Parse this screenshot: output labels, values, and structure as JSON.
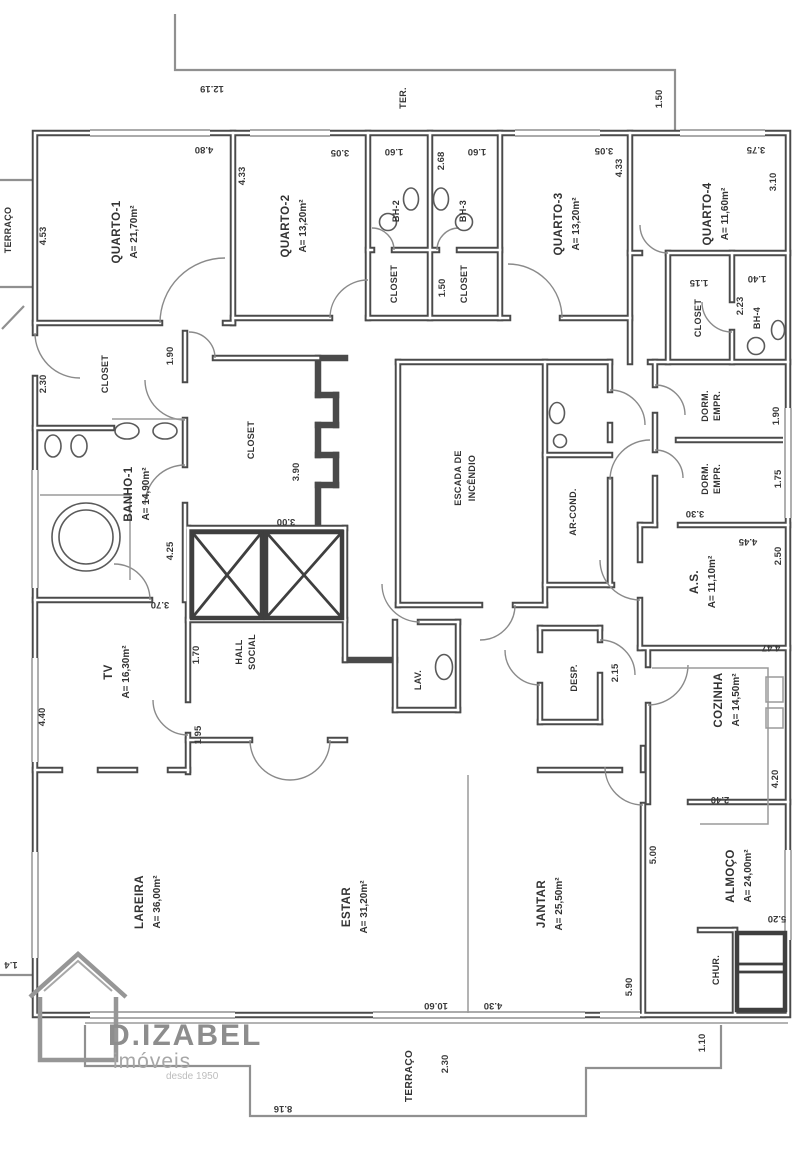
{
  "branding": {
    "name": "D.IZABEL",
    "subtitle": "imóveis",
    "tagline": "desde 1950"
  },
  "rooms": {
    "quarto1": {
      "name": "QUARTO-1",
      "area": "A= 21,70m²"
    },
    "quarto2": {
      "name": "QUARTO-2",
      "area": "A= 13,20m²"
    },
    "quarto3": {
      "name": "QUARTO-3",
      "area": "A= 13,20m²"
    },
    "quarto4": {
      "name": "QUARTO-4",
      "area": "A= 11,60m²"
    },
    "banho1": {
      "name": "BANHO-1",
      "area": "A= 14,90m²"
    },
    "tv": {
      "name": "TV",
      "area": "A= 16,30m²"
    },
    "cozinha": {
      "name": "COZINHA",
      "area": "A= 14,50m²"
    },
    "lareira": {
      "name": "LAREIRA",
      "area": "A= 36,00m²"
    },
    "estar": {
      "name": "ESTAR",
      "area": "A= 31,20m²"
    },
    "jantar": {
      "name": "JANTAR",
      "area": "A= 25,50m²"
    },
    "almoco": {
      "name": "ALMOÇO",
      "area": "A= 24,00m²"
    },
    "area_servico": {
      "name": "A.S.",
      "area": "A= 11,10m²"
    },
    "hall": {
      "line1": "HALL",
      "line2": "SOCIAL"
    },
    "escada": {
      "line1": "ESCADA DE",
      "line2": "INCÊNDIO"
    },
    "dorm_empr": {
      "line1": "DORM.",
      "line2": "EMPR."
    },
    "ar_cond": "AR-COND.",
    "lav": "LAV.",
    "desp": "DESP.",
    "chur": "CHUR.",
    "bh2": "BH-2",
    "bh3": "BH-3",
    "bh4": "BH-4",
    "closet": "CLOSET",
    "ter": "TER.",
    "terraco": "TERRAÇO"
  },
  "dimensions": {
    "top_width": "12.19",
    "terrace_right": "1.50",
    "q1_width": "4.80",
    "q1_depth": "4.33",
    "q1_left": "4.53",
    "q2_width": "3.05",
    "bh2_width": "1.60",
    "bh3_width": "1.60",
    "bh_depth": "2.68",
    "q3_width": "3.05",
    "q3_depth": "4.33",
    "q4_width": "3.75",
    "q4_depth": "3.10",
    "closet_mid": "1.50",
    "closet_q4": "1.15",
    "bh4_depth": "2.23",
    "bh4_width": "1.40",
    "closet1_width": "2.30",
    "closet1_depth": "1.90",
    "closet2_depth": "3.90",
    "closet2_width": "3.00",
    "banho1_depth": "4.25",
    "banho1_below": "3.70",
    "tv_depth": "4.40",
    "hall_width": "1.70",
    "hall_depth": "1.95",
    "dorm1_depth": "1.90",
    "dorm2_depth": "1.75",
    "dorm_width": "3.30",
    "as_width": "4.45",
    "as_depth": "2.50",
    "cozinha_top": "4.47",
    "desp_depth": "2.15",
    "cozinha_depth": "4.20",
    "cozinha_width": "2.40",
    "jantar_side": "5.00",
    "jantar_depth": "5.90",
    "almoco_side": "5.20",
    "estar_width": "10.60",
    "jantar_width": "4.30",
    "chur_side": "1.10",
    "terraco_depth": "2.30",
    "terraco_width": "8.16",
    "left_edge": "1.4"
  }
}
